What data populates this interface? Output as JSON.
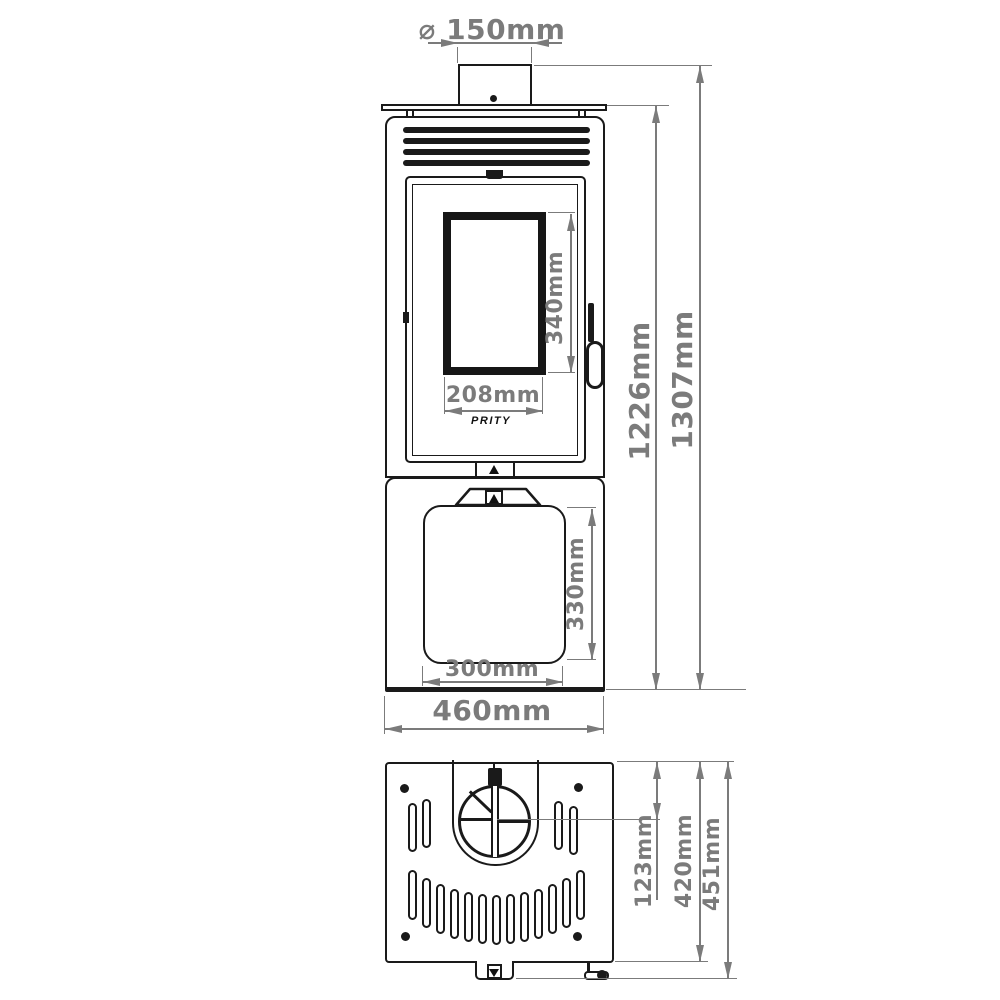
{
  "brand_logo": "PRITY",
  "colors": {
    "line": "#1a1a1a",
    "dimension": "#7b7b7b",
    "background": "#ffffff"
  },
  "front_view": {
    "flue_diameter": {
      "label": "⌀ 150mm",
      "value_mm": 150
    },
    "overall_height": {
      "label": "1307mm",
      "value_mm": 1307
    },
    "body_height": {
      "label": "1226mm",
      "value_mm": 1226
    },
    "glass_height": {
      "label": "340mm",
      "value_mm": 340
    },
    "glass_width": {
      "label": "208mm",
      "value_mm": 208
    },
    "lower_door_height": {
      "label": "330mm",
      "value_mm": 330
    },
    "lower_door_width": {
      "label": "300mm",
      "value_mm": 300
    },
    "overall_width": {
      "label": "460mm",
      "value_mm": 460
    }
  },
  "top_view": {
    "flue_center_offset": {
      "label": "123mm",
      "value_mm": 123
    },
    "body_depth": {
      "label": "420mm",
      "value_mm": 420
    },
    "overall_depth": {
      "label": "451mm",
      "value_mm": 451
    }
  }
}
